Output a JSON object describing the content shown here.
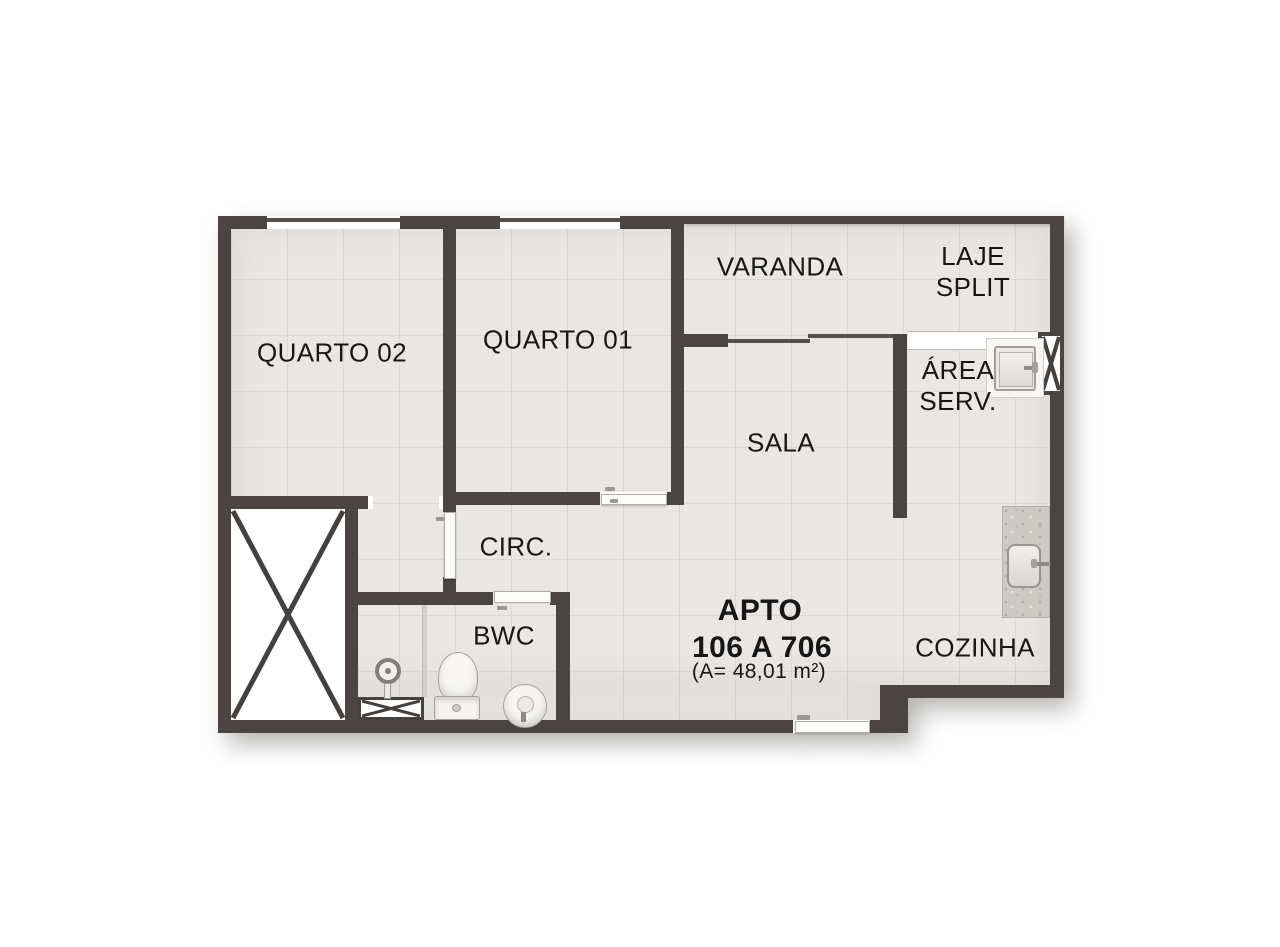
{
  "title_block": {
    "line1": "APTO",
    "line2": "106 A 706",
    "line3": "(A= 48,01 m²)"
  },
  "labels": {
    "quarto02": "QUARTO 02",
    "quarto01": "QUARTO 01",
    "varanda": "VARANDA",
    "laje_split_line1": "LAJE",
    "laje_split_line2": "SPLIT",
    "area_serv_line1": "ÁREA",
    "area_serv_line2": "SERV.",
    "sala": "SALA",
    "circ": "CIRC.",
    "bwc": "BWC",
    "cozinha": "COZINHA"
  },
  "fixtures": {
    "void_shaft": "x-cross-void",
    "duct_shaft": "x-cross-duct",
    "shower": "shower-head",
    "shower_tray": "x-cross-tray",
    "toilet": "toilet",
    "washbasin": "round-washbasin",
    "laundry_tank": "laundry-tank",
    "kitchen_sink": "kitchen-sink-counter"
  },
  "colors": {
    "wall": "#4a4542",
    "floor": "#e9e6e3",
    "tile_line": "#dcd9d5",
    "label_text": "#161616",
    "counter_granite": "#cdcac5",
    "fixture_outline": "#a5a29d",
    "background": "#ffffff"
  }
}
